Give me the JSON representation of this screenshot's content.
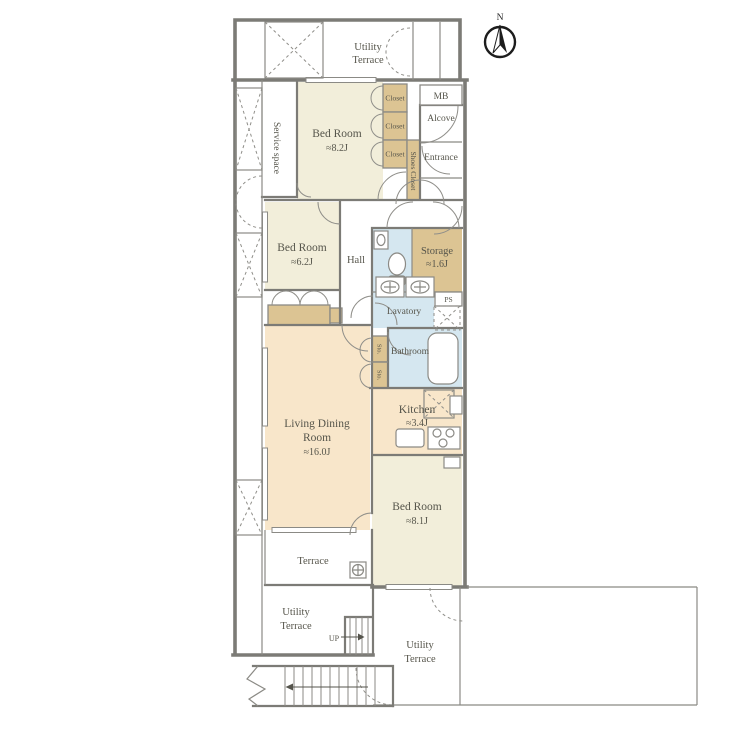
{
  "meta": {
    "type": "apartment-floor-plan"
  },
  "palette": {
    "bedroom_fill": "#f2eeda",
    "living_fill": "#f8e6ca",
    "closet_fill": "#dcc493",
    "wet_fill": "#d5e7f0",
    "tub_fill": "#edf4f8"
  },
  "compass": {
    "north": "N"
  },
  "rooms": {
    "utility_terrace_top": {
      "line1": "Utility",
      "line2": "Terrace"
    },
    "service_space": {
      "label": "Service space"
    },
    "bedroom_82": {
      "name": "Bed Room",
      "size": "≈8.2J"
    },
    "closet_a": {
      "label": "Closet"
    },
    "closet_b": {
      "label": "Closet"
    },
    "closet_c": {
      "label": "Closet"
    },
    "shoes_closet": {
      "label": "Shoes Closet"
    },
    "mb": {
      "label": "MB"
    },
    "alcove": {
      "label": "Alcove"
    },
    "entrance": {
      "label": "Entrance"
    },
    "bedroom_62": {
      "name": "Bed Room",
      "size": "≈6.2J"
    },
    "hall": {
      "label": "Hall"
    },
    "storage": {
      "name": "Storage",
      "size": "≈1.6J"
    },
    "ps": {
      "label": "PS"
    },
    "lavatory": {
      "label": "Lavatory"
    },
    "bathroom": {
      "label": "Bathroom"
    },
    "sto_a": {
      "label": "Sto."
    },
    "sto_b": {
      "label": "Sto."
    },
    "living_dining": {
      "name_line1": "Living Dining",
      "name_line2": "Room",
      "size": "≈16.0J"
    },
    "kitchen": {
      "name": "Kitchen",
      "size": "≈3.4J"
    },
    "bedroom_81": {
      "name": "Bed Room",
      "size": "≈8.1J"
    },
    "terrace": {
      "label": "Terrace"
    },
    "utility_terrace_left": {
      "line1": "Utility",
      "line2": "Terrace"
    },
    "utility_terrace_right": {
      "line1": "Utility",
      "line2": "Terrace"
    },
    "stairs": {
      "up_label": "UP"
    }
  }
}
